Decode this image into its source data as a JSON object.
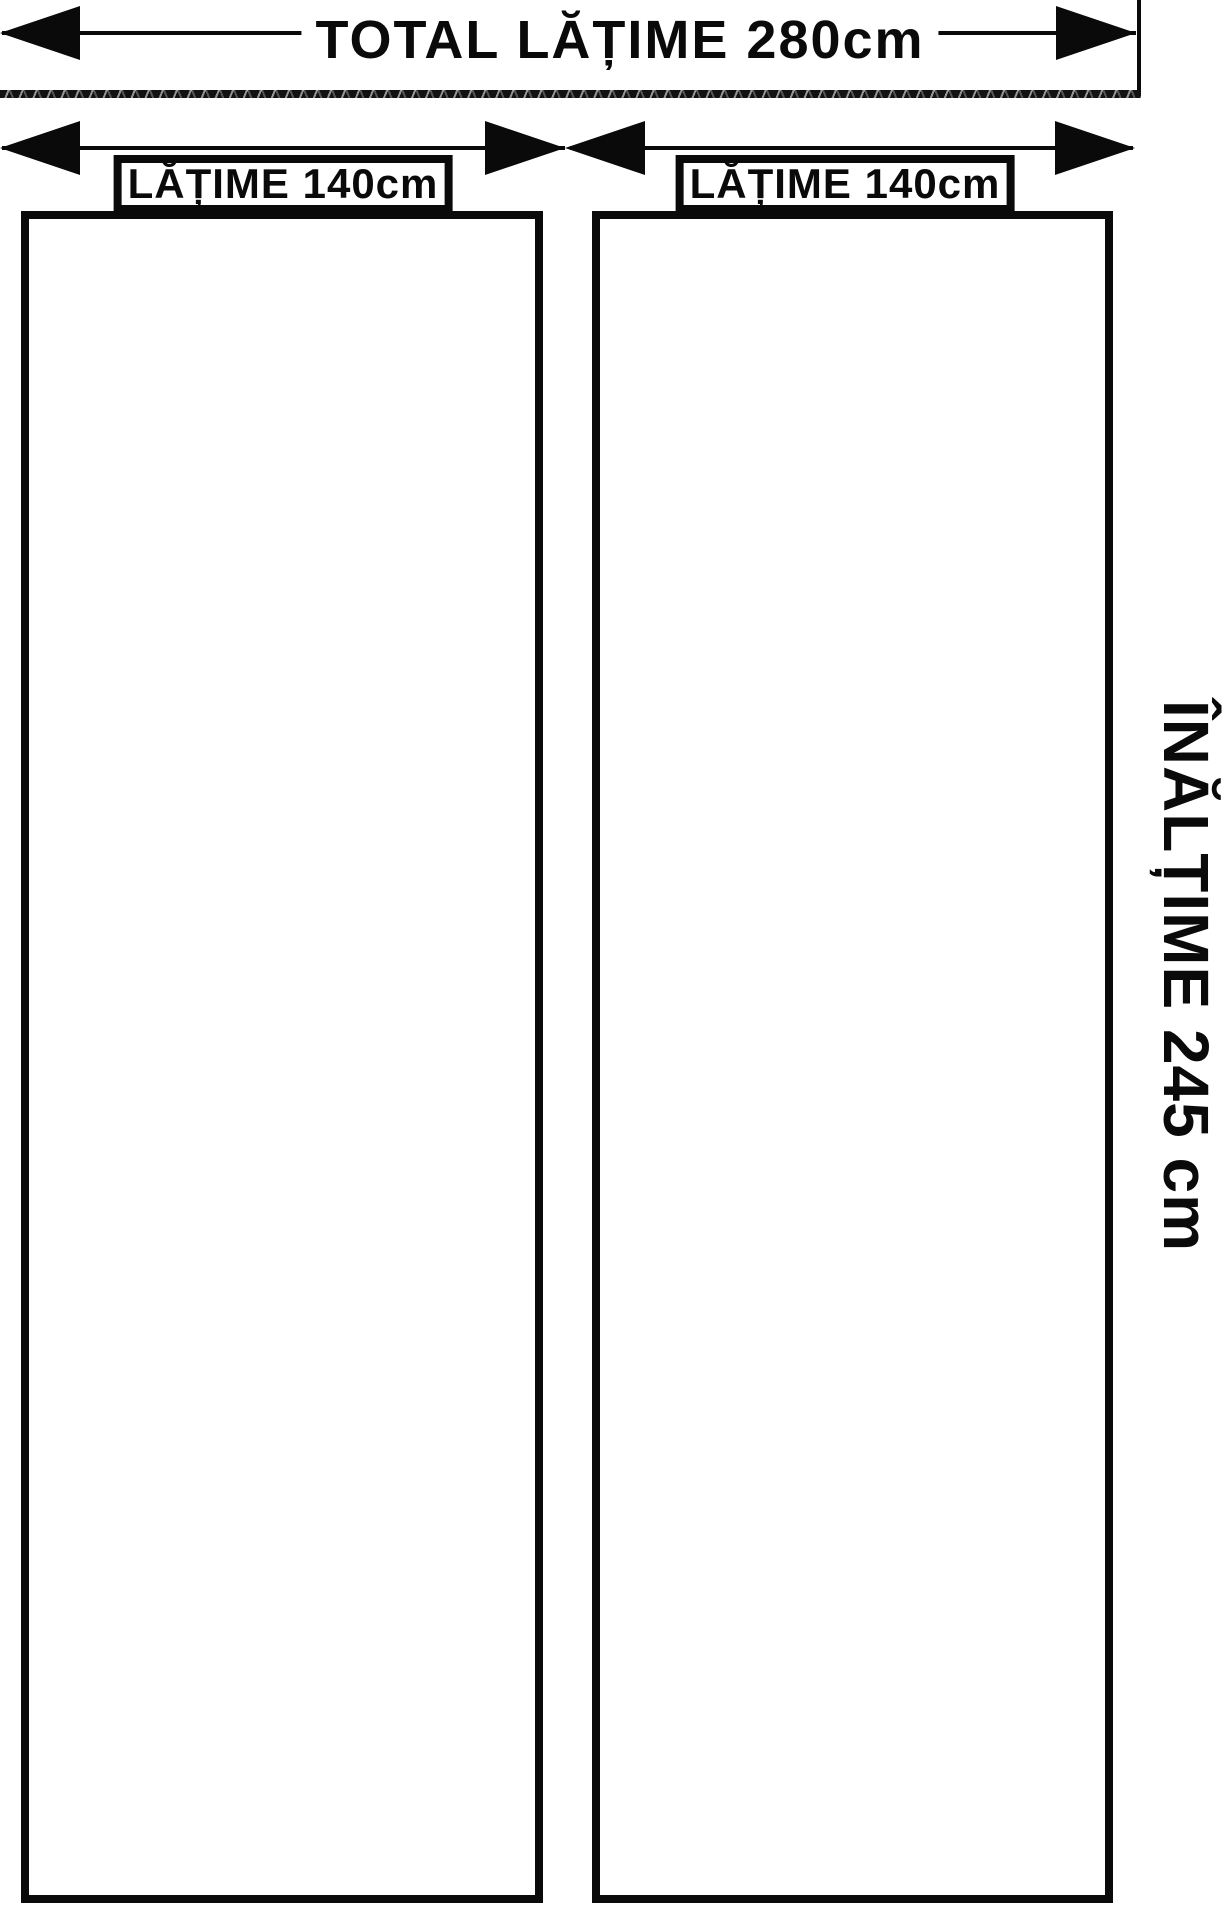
{
  "diagram": {
    "title": "curtain-panel-dimensions",
    "colors": {
      "ink": "#0a0a0a",
      "background": "#ffffff"
    },
    "top_dimension": {
      "label": "TOTAL LĂȚIME 280cm"
    },
    "panels": [
      {
        "dimension_label": "LĂȚIME 140cm"
      },
      {
        "dimension_label": "LĂȚIME 140cm"
      }
    ],
    "height_dimension": {
      "label": "ÎNĂLȚIME 245 cm"
    }
  }
}
